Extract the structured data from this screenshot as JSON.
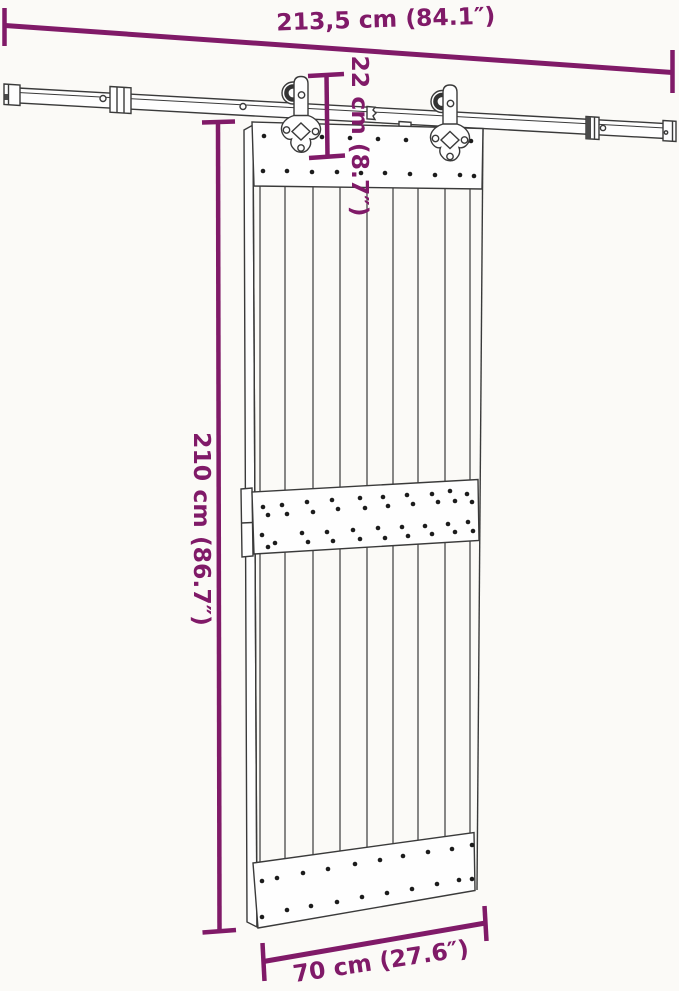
{
  "diagram": {
    "dimensions": {
      "rail_length": {
        "label": "213,5 cm (84.1″)",
        "cm": "213,5",
        "inches": "84.1"
      },
      "hanger_drop": {
        "label": "22 cm (8.7″)",
        "cm": "22",
        "inches": "8.7"
      },
      "door_height": {
        "label": "210 cm (86.7″)",
        "cm": "210",
        "inches": "86.7"
      },
      "door_width": {
        "label": "70 cm (27.6″)",
        "cm": "70",
        "inches": "27.6"
      }
    },
    "colors": {
      "dimension_accent": "#801a68",
      "drawing_line": "#3a3a3a",
      "background": "#fbfaf7"
    }
  }
}
